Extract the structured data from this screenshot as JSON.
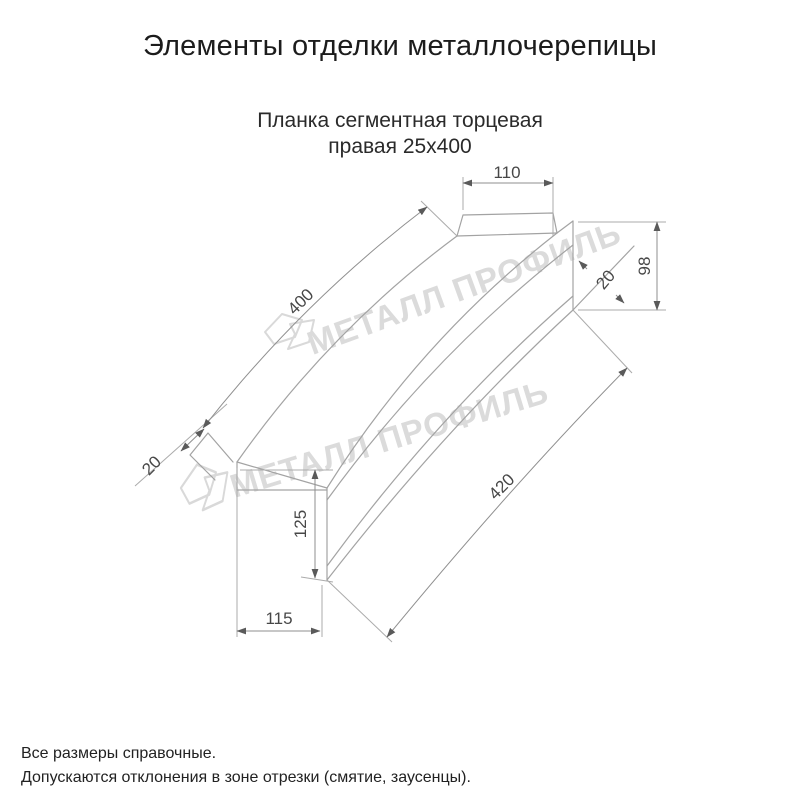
{
  "page": {
    "title": "Элементы отделки металлочерепицы"
  },
  "product": {
    "name_line1": "Планка сегментная торцевая",
    "name_line2": "правая 25х400"
  },
  "drawing": {
    "type": "technical-dimension-drawing",
    "dimensions": {
      "top_end_width": "110",
      "right_end_height": "98",
      "right_end_hem": "20",
      "top_edge_length": "400",
      "left_end_hem": "20",
      "left_end_height": "125",
      "bottom_edge_length": "420",
      "bottom_end_width": "115"
    },
    "watermark_text": "МЕТАЛЛ ПРОФИЛЬ"
  },
  "footer": {
    "note_line1": "Все размеры справочные.",
    "note_line2": "Допускаются отклонения в зоне отрезки (смятие, заусенцы)."
  },
  "colors": {
    "outline": "#a3a3a3",
    "dimension_line": "#8f8f8f",
    "dimension_text": "#474747",
    "watermark": "#dbdbdb",
    "text": "#1c1c1c",
    "background": "#ffffff"
  }
}
